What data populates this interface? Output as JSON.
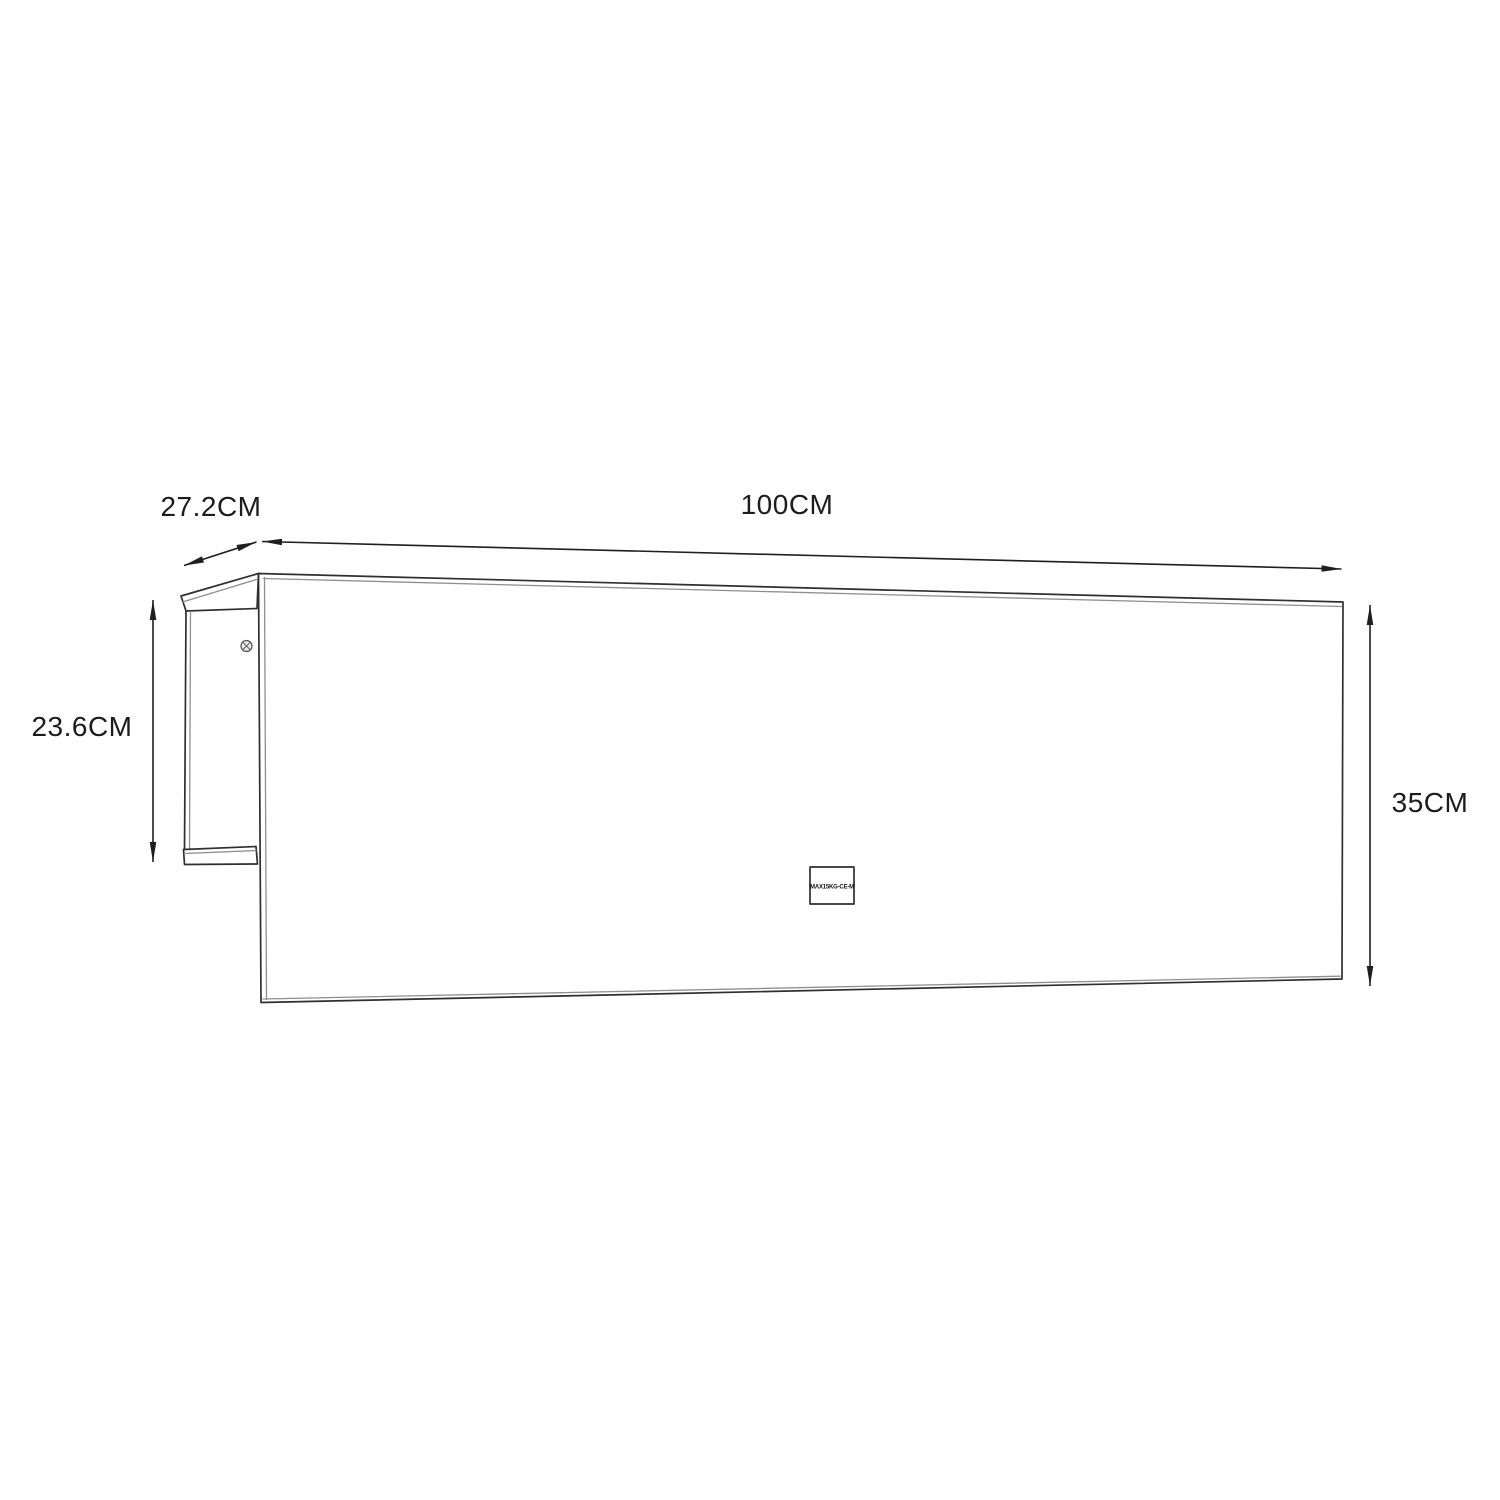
{
  "diagram": {
    "kind": "furniture-dimension-drawing",
    "dimensions": {
      "depth_label": "27.2CM",
      "width_label": "100CM",
      "side_height_label": "23.6CM",
      "front_height_label": "35CM"
    },
    "load_badge": "MAX15KG-CE-M",
    "colors": {
      "background": "#ffffff",
      "line": "#2f2f2f",
      "line_secondary": "#8f8f8f",
      "dimension_line": "#1f1f1f",
      "text": "#1c1c1c"
    }
  }
}
